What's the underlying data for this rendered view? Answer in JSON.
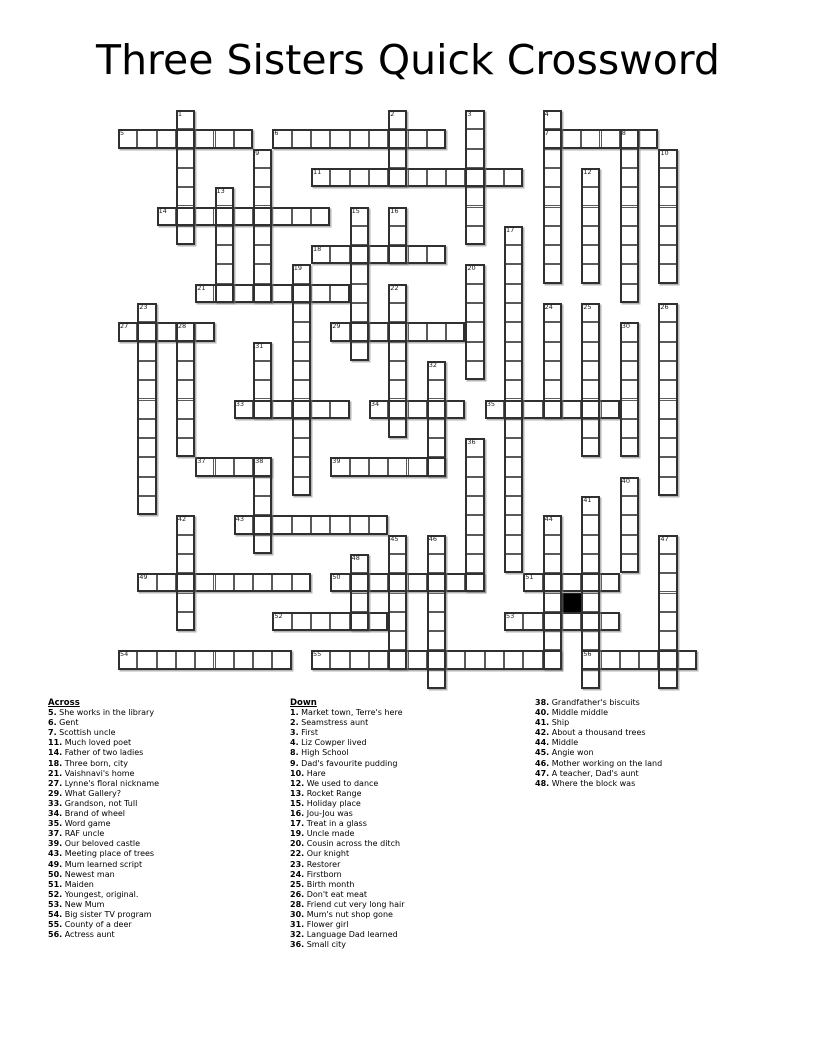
{
  "title": "Three Sisters Quick Crossword",
  "grid": {
    "rows": 30,
    "cols": 30,
    "black_cells": [
      {
        "row": 25,
        "col": 23
      }
    ],
    "words": [
      {
        "num": 5,
        "dir": "across",
        "row": 1,
        "col": 0,
        "len": 7
      },
      {
        "num": 6,
        "dir": "across",
        "row": 1,
        "col": 8,
        "len": 9
      },
      {
        "num": 7,
        "dir": "across",
        "row": 1,
        "col": 22,
        "len": 6
      },
      {
        "num": 11,
        "dir": "across",
        "row": 3,
        "col": 10,
        "len": 11
      },
      {
        "num": 14,
        "dir": "across",
        "row": 5,
        "col": 2,
        "len": 9
      },
      {
        "num": 18,
        "dir": "across",
        "row": 7,
        "col": 10,
        "len": 7
      },
      {
        "num": 21,
        "dir": "across",
        "row": 9,
        "col": 4,
        "len": 8
      },
      {
        "num": 27,
        "dir": "across",
        "row": 11,
        "col": 0,
        "len": 5
      },
      {
        "num": 29,
        "dir": "across",
        "row": 11,
        "col": 11,
        "len": 7
      },
      {
        "num": 33,
        "dir": "across",
        "row": 15,
        "col": 6,
        "len": 6
      },
      {
        "num": 34,
        "dir": "across",
        "row": 15,
        "col": 13,
        "len": 5
      },
      {
        "num": 35,
        "dir": "across",
        "row": 15,
        "col": 19,
        "len": 7
      },
      {
        "num": 37,
        "dir": "across",
        "row": 18,
        "col": 4,
        "len": 4
      },
      {
        "num": 39,
        "dir": "across",
        "row": 18,
        "col": 11,
        "len": 6
      },
      {
        "num": 43,
        "dir": "across",
        "row": 21,
        "col": 6,
        "len": 8
      },
      {
        "num": 49,
        "dir": "across",
        "row": 24,
        "col": 1,
        "len": 9
      },
      {
        "num": 50,
        "dir": "across",
        "row": 24,
        "col": 11,
        "len": 8
      },
      {
        "num": 51,
        "dir": "across",
        "row": 24,
        "col": 21,
        "len": 5
      },
      {
        "num": 52,
        "dir": "across",
        "row": 26,
        "col": 8,
        "len": 6
      },
      {
        "num": 53,
        "dir": "across",
        "row": 26,
        "col": 20,
        "len": 6
      },
      {
        "num": 54,
        "dir": "across",
        "row": 28,
        "col": 0,
        "len": 9
      },
      {
        "num": 55,
        "dir": "across",
        "row": 28,
        "col": 10,
        "len": 13
      },
      {
        "num": 56,
        "dir": "across",
        "row": 28,
        "col": 24,
        "len": 6
      },
      {
        "num": 1,
        "dir": "down",
        "row": 0,
        "col": 3,
        "len": 7
      },
      {
        "num": 2,
        "dir": "down",
        "row": 0,
        "col": 14,
        "len": 4
      },
      {
        "num": 3,
        "dir": "down",
        "row": 0,
        "col": 18,
        "len": 7
      },
      {
        "num": 4,
        "dir": "down",
        "row": 0,
        "col": 22,
        "len": 9
      },
      {
        "num": 8,
        "dir": "down",
        "row": 1,
        "col": 26,
        "len": 9
      },
      {
        "num": 9,
        "dir": "down",
        "row": 2,
        "col": 7,
        "len": 8
      },
      {
        "num": 10,
        "dir": "down",
        "row": 2,
        "col": 28,
        "len": 7
      },
      {
        "num": 12,
        "dir": "down",
        "row": 3,
        "col": 24,
        "len": 6
      },
      {
        "num": 13,
        "dir": "down",
        "row": 4,
        "col": 5,
        "len": 6
      },
      {
        "num": 15,
        "dir": "down",
        "row": 5,
        "col": 12,
        "len": 8
      },
      {
        "num": 16,
        "dir": "down",
        "row": 5,
        "col": 14,
        "len": 3
      },
      {
        "num": 17,
        "dir": "down",
        "row": 6,
        "col": 20,
        "len": 18
      },
      {
        "num": 19,
        "dir": "down",
        "row": 8,
        "col": 9,
        "len": 12
      },
      {
        "num": 20,
        "dir": "down",
        "row": 8,
        "col": 18,
        "len": 6
      },
      {
        "num": 22,
        "dir": "down",
        "row": 9,
        "col": 14,
        "len": 8
      },
      {
        "num": 23,
        "dir": "down",
        "row": 10,
        "col": 1,
        "len": 11
      },
      {
        "num": 24,
        "dir": "down",
        "row": 10,
        "col": 22,
        "len": 6
      },
      {
        "num": 25,
        "dir": "down",
        "row": 10,
        "col": 24,
        "len": 8
      },
      {
        "num": 26,
        "dir": "down",
        "row": 10,
        "col": 28,
        "len": 10
      },
      {
        "num": 28,
        "dir": "down",
        "row": 11,
        "col": 3,
        "len": 7
      },
      {
        "num": 30,
        "dir": "down",
        "row": 11,
        "col": 26,
        "len": 7
      },
      {
        "num": 31,
        "dir": "down",
        "row": 12,
        "col": 7,
        "len": 4
      },
      {
        "num": 32,
        "dir": "down",
        "row": 13,
        "col": 16,
        "len": 6
      },
      {
        "num": 36,
        "dir": "down",
        "row": 17,
        "col": 18,
        "len": 8
      },
      {
        "num": 38,
        "dir": "down",
        "row": 18,
        "col": 7,
        "len": 5
      },
      {
        "num": 40,
        "dir": "down",
        "row": 19,
        "col": 26,
        "len": 5
      },
      {
        "num": 41,
        "dir": "down",
        "row": 20,
        "col": 24,
        "len": 10
      },
      {
        "num": 42,
        "dir": "down",
        "row": 21,
        "col": 3,
        "len": 6
      },
      {
        "num": 44,
        "dir": "down",
        "row": 21,
        "col": 22,
        "len": 8
      },
      {
        "num": 45,
        "dir": "down",
        "row": 22,
        "col": 14,
        "len": 7
      },
      {
        "num": 46,
        "dir": "down",
        "row": 22,
        "col": 16,
        "len": 8
      },
      {
        "num": 47,
        "dir": "down",
        "row": 22,
        "col": 28,
        "len": 8
      },
      {
        "num": 48,
        "dir": "down",
        "row": 23,
        "col": 12,
        "len": 4
      }
    ]
  },
  "clues": {
    "across_heading": "Across",
    "down_heading": "Down",
    "across": [
      {
        "num": 5,
        "text": "She works in the library"
      },
      {
        "num": 6,
        "text": "Gent"
      },
      {
        "num": 7,
        "text": "Scottish uncle"
      },
      {
        "num": 11,
        "text": "Much loved poet"
      },
      {
        "num": 14,
        "text": "Father of two ladies"
      },
      {
        "num": 18,
        "text": "Three born, city"
      },
      {
        "num": 21,
        "text": "Vaishnavi's home"
      },
      {
        "num": 27,
        "text": "Lynne's floral nickname"
      },
      {
        "num": 29,
        "text": "What Gallery?"
      },
      {
        "num": 33,
        "text": "Grandson, not Tull"
      },
      {
        "num": 34,
        "text": "Brand of wheel"
      },
      {
        "num": 35,
        "text": "Word game"
      },
      {
        "num": 37,
        "text": "RAF uncle"
      },
      {
        "num": 39,
        "text": "Our beloved castle"
      },
      {
        "num": 43,
        "text": "Meeting place of trees"
      },
      {
        "num": 49,
        "text": "Mum learned script"
      },
      {
        "num": 50,
        "text": "Newest man"
      },
      {
        "num": 51,
        "text": "Maiden"
      },
      {
        "num": 52,
        "text": "Youngest, original."
      },
      {
        "num": 53,
        "text": "New Mum"
      },
      {
        "num": 54,
        "text": "Big sister TV program"
      },
      {
        "num": 55,
        "text": "County of a deer"
      },
      {
        "num": 56,
        "text": "Actress aunt"
      }
    ],
    "down": [
      {
        "num": 1,
        "text": "Market town, Terre's here"
      },
      {
        "num": 2,
        "text": "Seamstress aunt"
      },
      {
        "num": 3,
        "text": "First"
      },
      {
        "num": 4,
        "text": "Liz Cowper lived"
      },
      {
        "num": 8,
        "text": "High School"
      },
      {
        "num": 9,
        "text": "Dad's favourite pudding"
      },
      {
        "num": 10,
        "text": "Hare"
      },
      {
        "num": 12,
        "text": "We used to dance"
      },
      {
        "num": 13,
        "text": "Rocket Range"
      },
      {
        "num": 15,
        "text": "Holiday place"
      },
      {
        "num": 16,
        "text": "Jou-Jou was"
      },
      {
        "num": 17,
        "text": "Treat in a glass"
      },
      {
        "num": 19,
        "text": "Uncle made"
      },
      {
        "num": 20,
        "text": "Cousin across the ditch"
      },
      {
        "num": 22,
        "text": "Our knight"
      },
      {
        "num": 23,
        "text": "Restorer"
      },
      {
        "num": 24,
        "text": "Firstborn"
      },
      {
        "num": 25,
        "text": "Birth month"
      },
      {
        "num": 26,
        "text": "Don't eat meat"
      },
      {
        "num": 28,
        "text": "Friend cut very long hair"
      },
      {
        "num": 30,
        "text": "Mum's nut shop gone"
      },
      {
        "num": 31,
        "text": "Flower girl"
      },
      {
        "num": 32,
        "text": "Language Dad learned"
      },
      {
        "num": 36,
        "text": "Small city"
      },
      {
        "num": 38,
        "text": "Grandfather's biscuits"
      },
      {
        "num": 40,
        "text": "Middle middle"
      },
      {
        "num": 41,
        "text": "Ship"
      },
      {
        "num": 42,
        "text": "About a thousand trees"
      },
      {
        "num": 44,
        "text": "Middle"
      },
      {
        "num": 45,
        "text": "Angie won"
      },
      {
        "num": 46,
        "text": "Mother working on the land"
      },
      {
        "num": 47,
        "text": "A teacher, Dad's aunt"
      },
      {
        "num": 48,
        "text": "Where the block was"
      }
    ],
    "down_column_break_after_num": 36
  }
}
